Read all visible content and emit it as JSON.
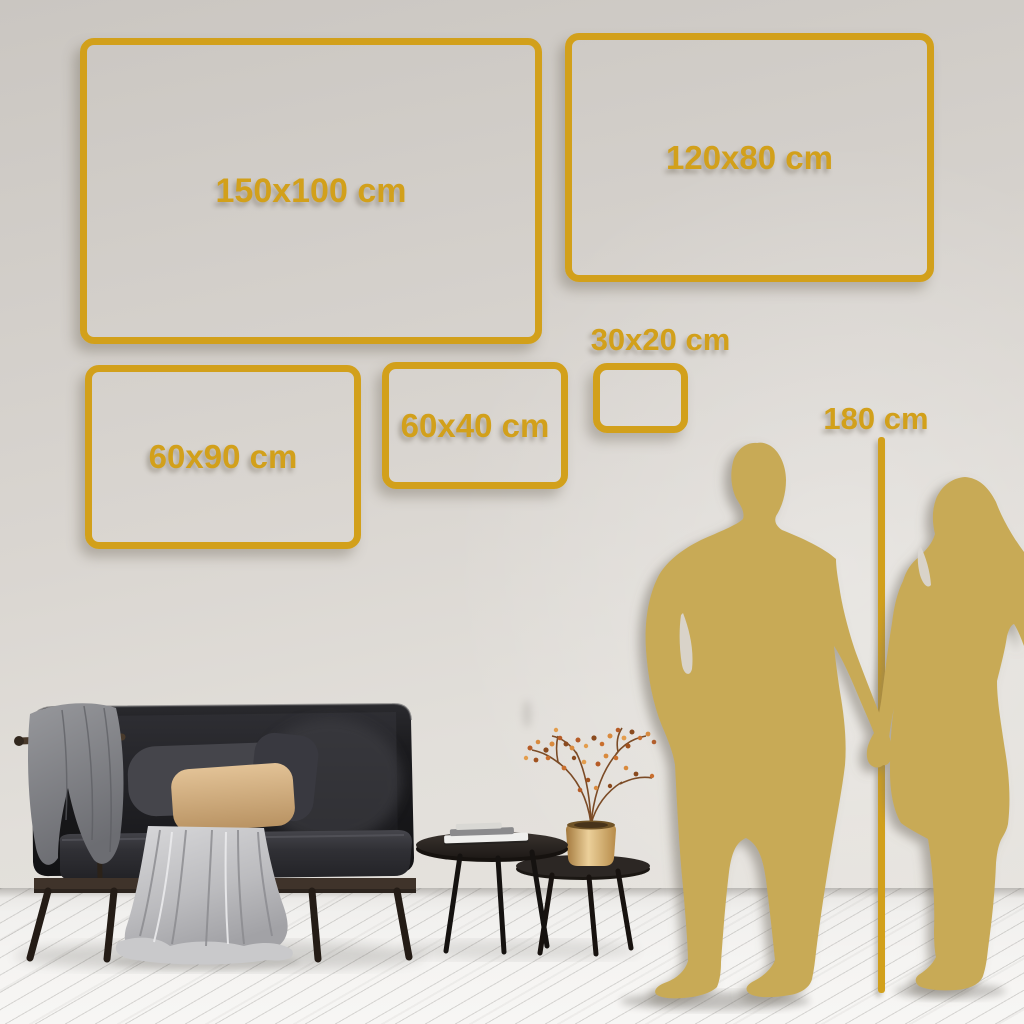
{
  "size_guide": {
    "frames": [
      {
        "id": "150x100",
        "label": "150x100 cm"
      },
      {
        "id": "120x80",
        "label": "120x80 cm"
      },
      {
        "id": "60x90",
        "label": "60x90 cm"
      },
      {
        "id": "60x40",
        "label": "60x40 cm"
      },
      {
        "id": "30x20",
        "label": "30x20 cm"
      }
    ],
    "reference_height": {
      "label": "180 cm"
    }
  },
  "colors": {
    "frame_gold": "#d2a01b",
    "silhouette_gold": "#c8aa56",
    "wall_light": "#e4e1dc",
    "wall_dark": "#cbc7c2",
    "floor": "#f4f3f1",
    "sofa_dark": "#1c1c1e",
    "pillow_beige": "#d9b488",
    "blanket_gray": "#8f9094",
    "vase_gold": "#c79c59",
    "berry_orange": "#c96f2e"
  }
}
